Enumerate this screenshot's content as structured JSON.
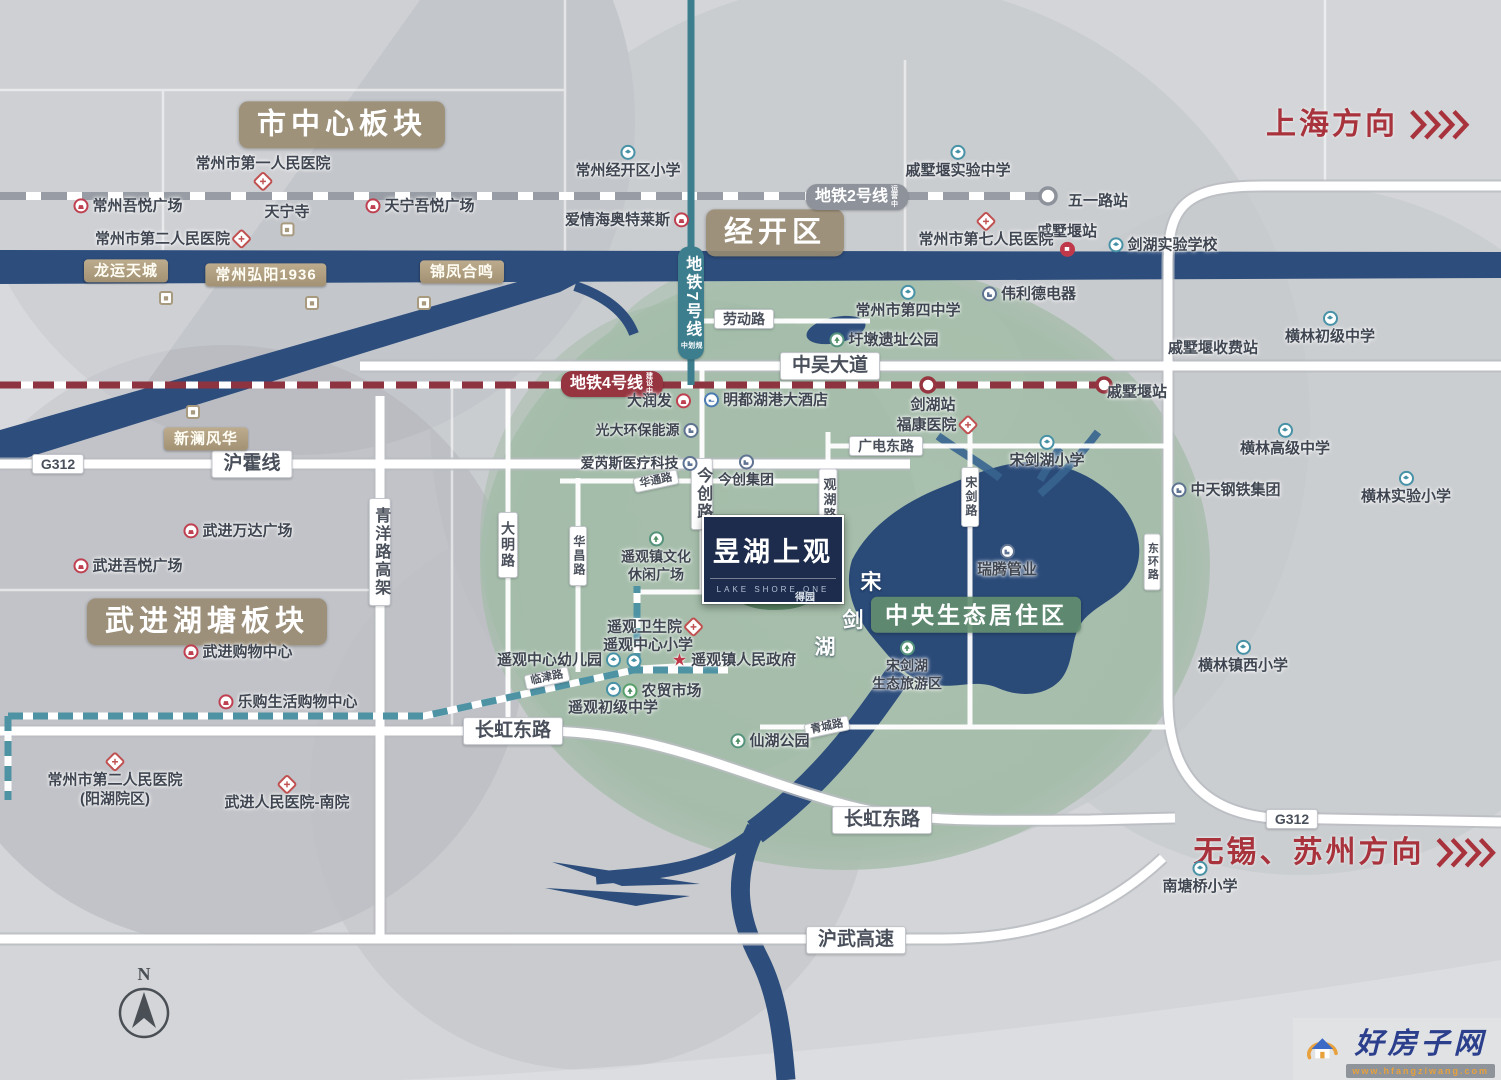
{
  "regions": {
    "city_center": "市中心板块",
    "jingkai": "经开区",
    "wujin_hutang": "武进湖塘板块",
    "central_eco": "中央生态居住区"
  },
  "directions": {
    "shanghai": "上海方向",
    "wuxi_suzhou": "无锡、苏州方向"
  },
  "metro": {
    "line2": {
      "name": "地铁2号线",
      "status": "运营中"
    },
    "line4": {
      "name": "地铁4号线",
      "status": "建设中"
    },
    "line7": {
      "name": "地铁7号线",
      "status": "规划中"
    }
  },
  "stations": {
    "wuyilu": "五一路站",
    "qishuyan_rail": "戚墅堰站",
    "qishuyan_metro": "戚墅堰站",
    "jianhu": "剑湖站",
    "qishuyan_toll": "戚墅堰收费站"
  },
  "roads": {
    "zhongwu": "中吴大道",
    "g312_left": "G312",
    "g312_right": "G312",
    "huhuo": "沪霍线",
    "laodong": "劳动路",
    "guangdian_east": "广电东路",
    "huatong": "华通路",
    "deyuan": "得园路",
    "linjin": "临津路",
    "qingcheng": "青城路",
    "changhong_east_1": "长虹东路",
    "changhong_east_2": "长虹东路",
    "huwu_expwy": "沪武高速",
    "qingyang_viaduct": "青洋路高架",
    "daming": "大明路",
    "huachang": "华昌路",
    "jinchuang": "今创路",
    "guanhu": "观湖路",
    "songjian": "宋剑路",
    "donghuan": "东环路"
  },
  "project": {
    "name": "昱湖上观",
    "subtitle": "LAKE SHORE ONE"
  },
  "lake": {
    "char1": "宋",
    "char2": "剑",
    "char3": "湖",
    "island": "得园",
    "scenic_l1": "宋剑湖",
    "scenic_l2": "生态旅游区"
  },
  "pois": {
    "hospital_no1": "常州市第一人民医院",
    "wuyue_changzhou": "常州吾悦广场",
    "tianningsi": "天宁寺",
    "wuyue_tianning": "天宁吾悦广场",
    "hospital_no2": "常州市第二人民医院",
    "longyun": "龙运天城",
    "hongyang": "常州弘阳1936",
    "jinfeng": "锦凤合鸣",
    "xinlan": "新澜风华",
    "jingkai_primary": "常州经开区小学",
    "aiqinghai": "爱情海奥特莱斯",
    "qishuyan_exp_middle": "戚墅堰实验中学",
    "hospital_no7": "常州市第七人民医院",
    "jianhu_exp_school": "剑湖实验学校",
    "weilide": "伟利德电器",
    "no4_middle": "常州市第四中学",
    "yudun_park": "圩墩遗址公园",
    "henglin_junior": "横林初级中学",
    "mingdu_hotel": "明都湖港大酒店",
    "darunfa": "大润发",
    "guangda": "光大环保能源",
    "airuisi": "爱芮斯医疗科技",
    "jinchuang_group": "今创集团",
    "fukang": "福康医院",
    "songjianhu_primary": "宋剑湖小学",
    "henglin_senior": "横林高级中学",
    "henglin_exp_primary": "横林实验小学",
    "zhongtian": "中天钢铁集团",
    "ruiteng": "瑞腾管业",
    "yaoguan_culture_l1": "遥观镇文化",
    "yaoguan_culture_l2": "休闲广场",
    "yaoguan_health": "遥观卫生院",
    "yaoguan_primary": "遥观中心小学",
    "yaoguan_kindergarten": "遥观中心幼儿园",
    "yaoguan_gov": "遥观镇人民政府",
    "nongmao": "农贸市场",
    "yaoguan_junior": "遥观初级中学",
    "xianhu_park": "仙湖公园",
    "henglin_west_primary": "横林镇西小学",
    "nantangqiao_primary": "南塘桥小学",
    "wanda": "武进万达广场",
    "wuyue_wujin": "武进吾悦广场",
    "wujin_shopping": "武进购物中心",
    "legou": "乐购生活购物中心",
    "hospital_no2_yanghu_l1": "常州市第二人民医院",
    "hospital_no2_yanghu_l2": "(阳湖院区)",
    "wujin_hospital_south": "武进人民医院-南院"
  },
  "compass": {
    "north": "N"
  },
  "watermark": {
    "site": "好房子网",
    "url": "www.hfangziwang.com"
  }
}
